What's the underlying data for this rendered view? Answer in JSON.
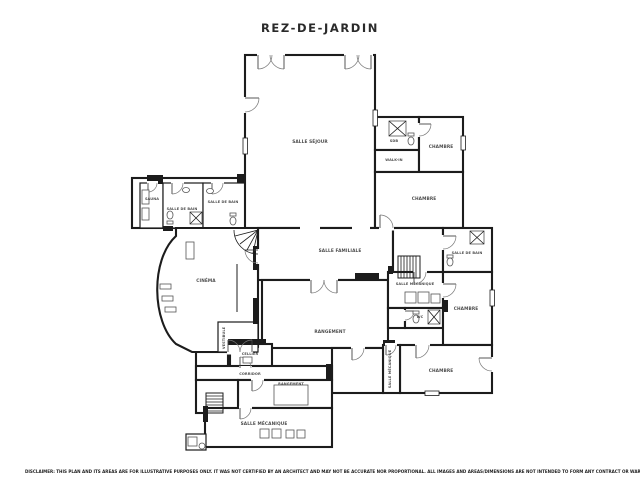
{
  "title": "REZ-DE-JARDIN",
  "disclaimer": "DISCLAIMER: THIS PLAN AND ITS AREAS ARE FOR ILLUSTRATIVE PURPOSES ONLY. IT WAS NOT CERTIFIED BY AN ARCHITECT AND MAY NOT BE ACCURATE NOR PROPORTIONAL. ALL IMAGES AND AREAS/DIMENSIONS ARE NOT INTENDED TO FORM ANY CONTRACT OR WARRANTY.",
  "colors": {
    "wall": "#1c1c1c",
    "room_label": "#4d4d4d",
    "background": "#ffffff"
  },
  "floor_plan": {
    "level_name": "REZ-DE-JARDIN",
    "rooms": [
      {
        "id": "salle-sejour",
        "label": "SALLE SÉJOUR"
      },
      {
        "id": "sdb",
        "label": "SDB"
      },
      {
        "id": "walk-in",
        "label": "WALK-IN"
      },
      {
        "id": "chambre-1",
        "label": "CHAMBRE"
      },
      {
        "id": "chambre-2",
        "label": "CHAMBRE"
      },
      {
        "id": "sauna",
        "label": "SAUNA"
      },
      {
        "id": "salle-de-bain-1",
        "label": "SALLE DE BAIN"
      },
      {
        "id": "salle-de-bain-2",
        "label": "SALLE DE BAIN"
      },
      {
        "id": "salle-familiale",
        "label": "SALLE FAMILIALE"
      },
      {
        "id": "salle-de-bain-3",
        "label": "SALLE DE BAIN"
      },
      {
        "id": "cinema",
        "label": "CINÉMA"
      },
      {
        "id": "rangement-1",
        "label": "RANGEMENT"
      },
      {
        "id": "salle-mecanique-1",
        "label": "SALLE MÉCANIQUE"
      },
      {
        "id": "wc",
        "label": "WC"
      },
      {
        "id": "chambre-3",
        "label": "CHAMBRE"
      },
      {
        "id": "chambre-4",
        "label": "CHAMBRE"
      },
      {
        "id": "salle-mecanique-2",
        "label": "SALLE MÉCANIQUE"
      },
      {
        "id": "vestibule",
        "label": "VESTIBULE"
      },
      {
        "id": "cellier",
        "label": "CELLIER"
      },
      {
        "id": "corridor",
        "label": "CORRIDOR"
      },
      {
        "id": "rangement-2",
        "label": "RANGEMENT"
      },
      {
        "id": "salle-mecanique-3",
        "label": "SALLE MÉCANIQUE"
      }
    ]
  }
}
